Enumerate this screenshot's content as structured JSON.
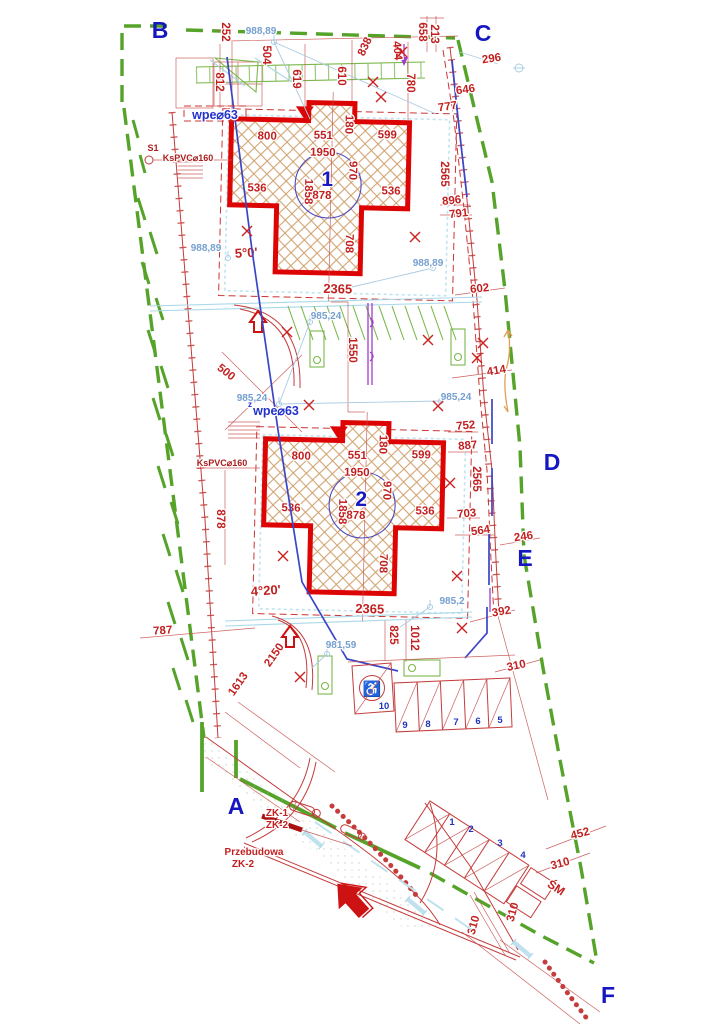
{
  "corners": {
    "a": "A",
    "b": "B",
    "c": "C",
    "d": "D",
    "e": "E",
    "f": "F"
  },
  "b1": {
    "num": "1",
    "area": "878",
    "w1": "800",
    "w2": "551",
    "w3": "599",
    "notch": "180",
    "iw": "1950",
    "ih": "970",
    "wingL": "536",
    "len": "1858",
    "wingR": "536",
    "shaft": "708",
    "total": "2365",
    "angle": "5°0'"
  },
  "b2": {
    "num": "2",
    "area": "878",
    "w1": "800",
    "w2": "551",
    "w3": "599",
    "notch": "180",
    "iw": "1950",
    "ih": "970",
    "wingL": "536",
    "len": "1858",
    "wingR": "536",
    "shaft": "708",
    "total": "2365",
    "angle": "4°20'"
  },
  "dims": {
    "d252": "252",
    "d812": "812",
    "d504": "504",
    "d619": "619",
    "d610": "610",
    "d838": "838",
    "d404": "404",
    "d780": "780",
    "d658": "658",
    "d213": "213",
    "d296": "296",
    "d646": "646",
    "d777": "777",
    "d2565a": "2565",
    "d896": "896",
    "d791": "791",
    "d602": "602",
    "d414": "414",
    "d752": "752",
    "d887": "887",
    "d2565b": "2565",
    "d703": "703",
    "d564": "564",
    "d246": "246",
    "d392": "392",
    "d310a": "310",
    "d452": "452",
    "d310b": "310",
    "d310c": "310",
    "d310d": "310",
    "d878": "878",
    "d787": "787",
    "d2150": "2150",
    "d1613": "1613",
    "d825": "825",
    "d1012": "1012",
    "d500": "500",
    "d1550": "1550"
  },
  "elev": {
    "e1": "988,89",
    "e2": "988,89",
    "e3": "988,89",
    "e4": "985,24",
    "e5": "985,24",
    "e6": "985,24",
    "e7": "985,2",
    "e8": "981,59"
  },
  "util": {
    "wpe1": "wpe⌀63",
    "wpe2": "wpe⌀63",
    "wpe2_sup": "z",
    "ks1": "KsPVC⌀160",
    "ks2": "KsPVC⌀160",
    "s1": "S1"
  },
  "parking": {
    "p10": "10",
    "p9": "9",
    "p8": "8",
    "p7": "7",
    "p6": "6",
    "p5": "5",
    "p1": "1",
    "p2": "2",
    "p3": "3",
    "p4": "4",
    "wheelchair_icon": "♿"
  },
  "notes": {
    "zk1": "ZK-1",
    "zk2": "ZK-2",
    "prz_line1": "Przebudowa",
    "prz_line2": "ZK-2",
    "sm": "ŚM"
  },
  "colors": {
    "boundary": "#56a32a",
    "building_outline": "#dd0404",
    "dimension": "#c22020",
    "elevation": "#76a0cf",
    "label_blue": "#1717c2"
  }
}
